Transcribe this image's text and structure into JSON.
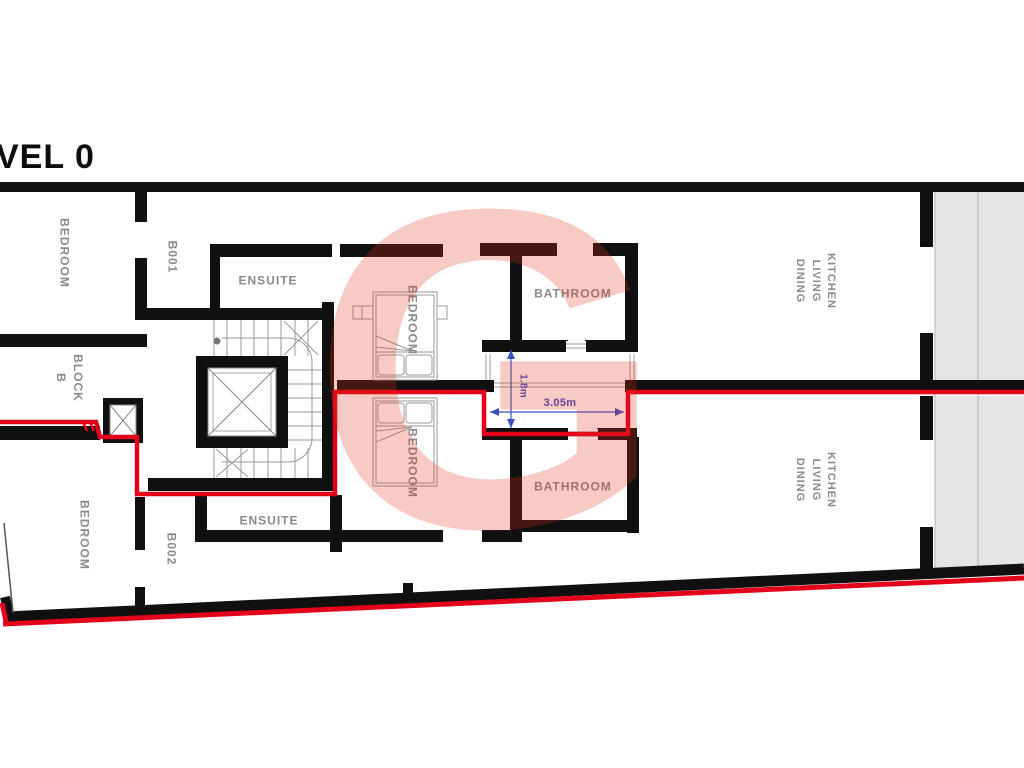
{
  "title": "VEL 0",
  "watermark_letter": "G",
  "colors": {
    "wall_black": "#101010",
    "escape_route_red": "#e2001a",
    "room_label_gray": "#8a8a8a",
    "dimension_blue": "#3b4fc0",
    "terrace_gray": "#e4e4e4",
    "watermark_pink": "rgba(224,49,31,0.26)"
  },
  "labels": {
    "bedroom_top_left": "BEDROOM",
    "b001": "B001",
    "ensuite_top": "ENSUITE",
    "bedroom_top_middle": "BEDROOM",
    "bathroom_top": "BATHROOM",
    "kitchen_living_dining_top": "KITCHEN\nLIVING\nDINING",
    "block_b": "BLOCK\nB",
    "bedroom_bottom_left": "BEDROOM",
    "b002": "B002",
    "ensuite_bottom": "ENSUITE",
    "bedroom_bottom_middle": "BEDROOM",
    "bathroom_bottom": "BATHROOM",
    "kitchen_living_dining_bottom": "KITCHEN\nLIVING\nDINING"
  },
  "dimensions": {
    "lightwell_width": "3.05m",
    "lightwell_height": "1.8m"
  }
}
